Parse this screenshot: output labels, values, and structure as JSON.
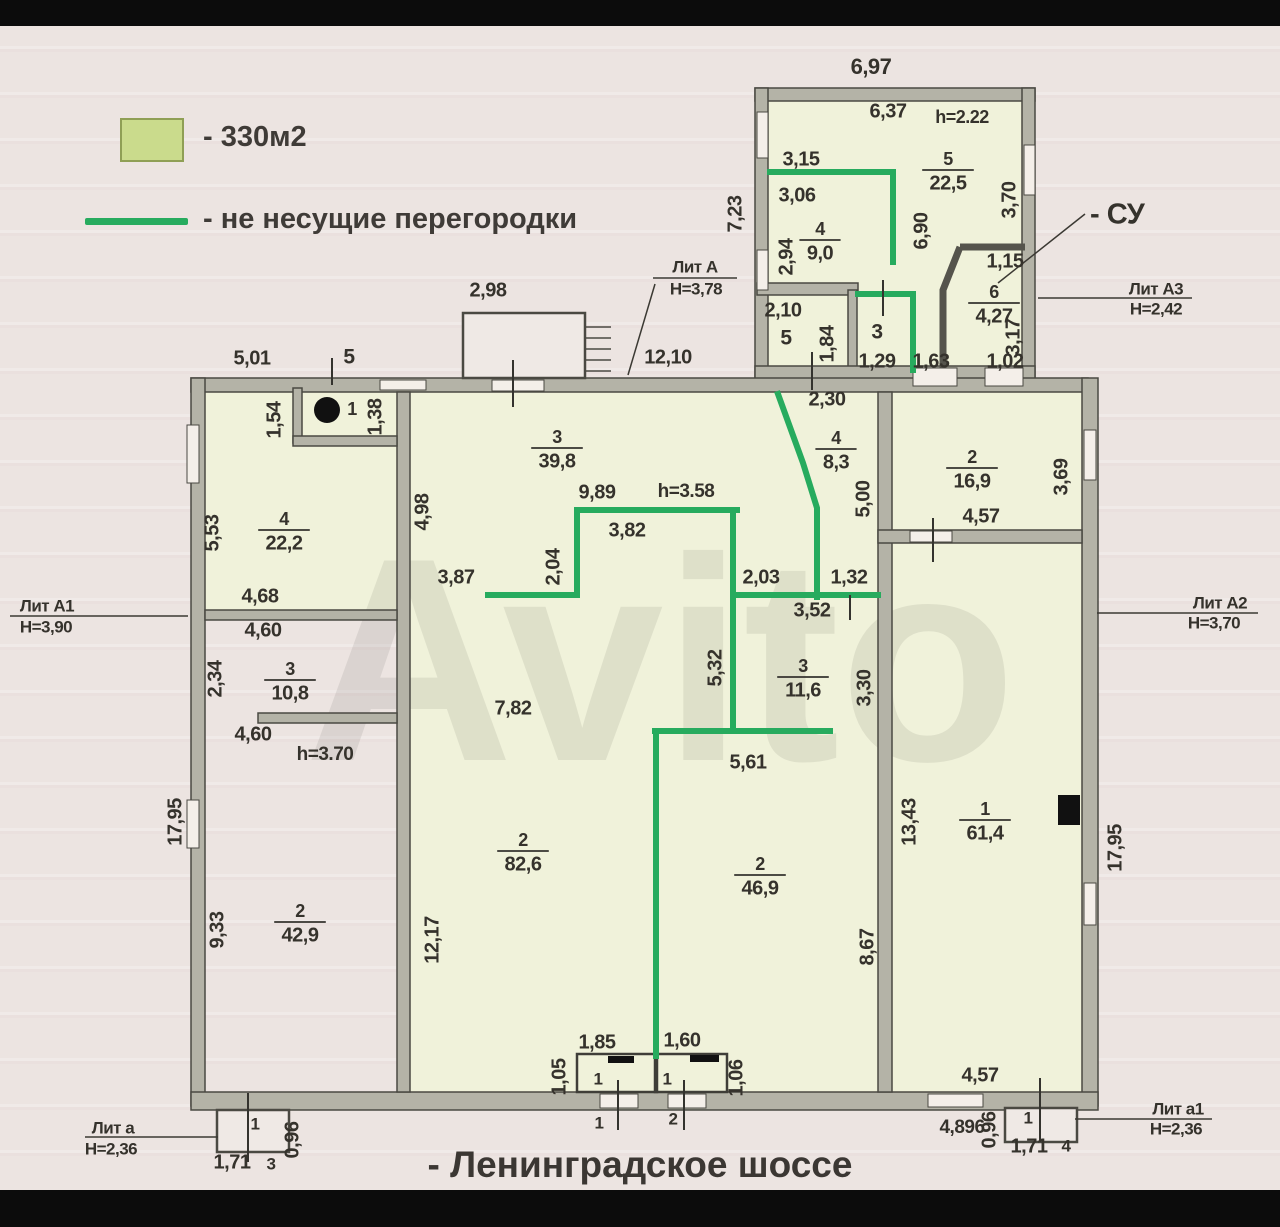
{
  "colors": {
    "paper": "#ece4e1",
    "letterbox": "#0c0c0c",
    "highlight_green_yellow": "#f0f2da",
    "partition_green": "#27ab5e",
    "legend_swatch": "#cadb8c",
    "legend_swatch_border": "#8f9f55",
    "wall_fill": "#b4b3a7",
    "wall_stroke": "#4a4942",
    "ink": "#35322c"
  },
  "legend": {
    "area_label": "- 330м2",
    "partition_label": "- не несущие перегородки"
  },
  "street_label": "- Ленинградское шоссе",
  "watermark": "Avito",
  "plan": {
    "highlights": [
      [
        762,
        98,
        262,
        270
      ],
      [
        205,
        392,
        192,
        220
      ],
      [
        410,
        392,
        468,
        700
      ],
      [
        892,
        392,
        190,
        700
      ]
    ],
    "walls": [
      [
        755,
        88,
        280,
        13
      ],
      [
        755,
        88,
        13,
        292
      ],
      [
        1022,
        88,
        13,
        292
      ],
      [
        757,
        283,
        101,
        12
      ],
      [
        848,
        290,
        9,
        80
      ],
      [
        755,
        366,
        280,
        16
      ],
      [
        191,
        378,
        897,
        14
      ],
      [
        191,
        378,
        14,
        728
      ],
      [
        1082,
        378,
        16,
        728
      ],
      [
        191,
        1092,
        907,
        18
      ],
      [
        397,
        392,
        13,
        700
      ],
      [
        878,
        392,
        14,
        700
      ],
      [
        293,
        388,
        9,
        55
      ],
      [
        293,
        436,
        104,
        10
      ],
      [
        205,
        610,
        192,
        10
      ],
      [
        258,
        713,
        139,
        10
      ],
      [
        878,
        530,
        204,
        13
      ]
    ],
    "wall_paths": [
      [
        [
          960,
          247
        ],
        [
          943,
          290
        ],
        [
          943,
          368
        ]
      ],
      [
        [
          960,
          247
        ],
        [
          1025,
          247
        ]
      ]
    ],
    "windows": [
      [
        187,
        425,
        12,
        58
      ],
      [
        187,
        800,
        12,
        48
      ],
      [
        757,
        112,
        11,
        46
      ],
      [
        757,
        250,
        11,
        40
      ],
      [
        1024,
        145,
        11,
        50
      ],
      [
        1084,
        430,
        12,
        50
      ],
      [
        1084,
        883,
        12,
        42
      ],
      [
        380,
        380,
        46,
        10
      ],
      [
        492,
        380,
        52,
        11
      ],
      [
        913,
        368,
        44,
        18
      ],
      [
        985,
        368,
        38,
        18
      ],
      [
        910,
        531,
        42,
        11
      ],
      [
        600,
        1094,
        38,
        14
      ],
      [
        668,
        1094,
        38,
        14
      ],
      [
        928,
        1094,
        55,
        13
      ]
    ],
    "porches": [
      [
        463,
        313,
        122,
        65
      ],
      [
        217,
        1110,
        72,
        42
      ],
      [
        1005,
        1108,
        72,
        34
      ]
    ],
    "vestibules": [
      [
        577,
        1054,
        80,
        38
      ],
      [
        655,
        1054,
        72,
        38
      ]
    ],
    "steps": {
      "x1": 585,
      "x2": 611,
      "y": 327,
      "dy": 11,
      "n": 5
    },
    "greens": [
      [
        [
          770,
          172
        ],
        [
          893,
          172
        ],
        [
          893,
          262
        ]
      ],
      [
        [
          858,
          294
        ],
        [
          913,
          294
        ],
        [
          913,
          370
        ]
      ],
      [
        [
          778,
          394
        ],
        [
          803,
          463
        ],
        [
          817,
          508
        ],
        [
          817,
          597
        ]
      ],
      [
        [
          488,
          595
        ],
        [
          577,
          595
        ],
        [
          577,
          510
        ],
        [
          737,
          510
        ]
      ],
      [
        [
          733,
          510
        ],
        [
          733,
          731
        ]
      ],
      [
        [
          733,
          595
        ],
        [
          878,
          595
        ]
      ],
      [
        [
          655,
          731
        ],
        [
          830,
          731
        ]
      ],
      [
        [
          656,
          731
        ],
        [
          656,
          1056
        ]
      ]
    ],
    "lines": [
      [
        653,
        278,
        737,
        278
      ],
      [
        628,
        375,
        655,
        284
      ],
      [
        10,
        616,
        188,
        616
      ],
      [
        1097,
        613,
        1258,
        613
      ],
      [
        1038,
        298,
        1192,
        298
      ],
      [
        998,
        283,
        1085,
        214
      ],
      [
        85,
        1137,
        218,
        1137
      ],
      [
        1075,
        1119,
        1212,
        1119
      ]
    ],
    "ticks": [
      [
        332,
        358,
        332,
        385
      ],
      [
        513,
        360,
        513,
        407
      ],
      [
        812,
        352,
        812,
        390
      ],
      [
        883,
        280,
        883,
        316
      ],
      [
        933,
        518,
        933,
        562
      ],
      [
        850,
        595,
        850,
        620
      ],
      [
        618,
        1080,
        618,
        1130
      ],
      [
        684,
        1080,
        684,
        1130
      ],
      [
        248,
        1093,
        248,
        1162
      ],
      [
        1040,
        1078,
        1040,
        1142
      ]
    ],
    "icons": {
      "stove_circle": {
        "cx": 327,
        "cy": 410,
        "r": 13
      },
      "vent_square": [
        1058,
        795,
        22,
        30
      ],
      "black_marks": [
        [
          608,
          1056,
          26,
          7
        ],
        [
          690,
          1055,
          29,
          7
        ]
      ]
    },
    "labels": [
      {
        "t": "6,97",
        "x": 871,
        "y": 68,
        "s": 22
      },
      {
        "t": "6,37",
        "x": 888,
        "y": 112
      },
      {
        "t": "h=2.22",
        "x": 962,
        "y": 118,
        "s": 18
      },
      {
        "t": "3,15",
        "x": 801,
        "y": 160
      },
      {
        "t": "3,06",
        "x": 797,
        "y": 196
      },
      {
        "t": "7,23",
        "x": 736,
        "y": 214,
        "r": 1
      },
      {
        "t": "2,94",
        "x": 787,
        "y": 257,
        "r": 1
      },
      {
        "t": "6,90",
        "x": 922,
        "y": 231,
        "r": 1
      },
      {
        "t": "3,70",
        "x": 1010,
        "y": 200,
        "r": 1
      },
      {
        "t": "1,15",
        "x": 1005,
        "y": 262
      },
      {
        "t": "3,17",
        "x": 1014,
        "y": 337,
        "r": 1
      },
      {
        "t": "2,10",
        "x": 783,
        "y": 311
      },
      {
        "t": "5",
        "x": 786,
        "y": 339,
        "s": 21
      },
      {
        "t": "1,84",
        "x": 828,
        "y": 344,
        "r": 1
      },
      {
        "t": "3",
        "x": 877,
        "y": 333,
        "s": 21
      },
      {
        "t": "1,29",
        "x": 877,
        "y": 362
      },
      {
        "t": "1,63",
        "x": 931,
        "y": 362
      },
      {
        "t": "1,02",
        "x": 1005,
        "y": 362
      },
      {
        "t": "2,30",
        "x": 827,
        "y": 400
      },
      {
        "t": "2,98",
        "x": 488,
        "y": 291
      },
      {
        "t": "12,10",
        "x": 668,
        "y": 358
      },
      {
        "t": "5,01",
        "x": 252,
        "y": 359
      },
      {
        "t": "5",
        "x": 349,
        "y": 358,
        "s": 21
      },
      {
        "t": "1,54",
        "x": 275,
        "y": 420,
        "r": 1
      },
      {
        "t": "1",
        "x": 352,
        "y": 410,
        "s": 18
      },
      {
        "t": "1,38",
        "x": 376,
        "y": 417,
        "r": 1
      },
      {
        "t": "5,53",
        "x": 213,
        "y": 533,
        "r": 1
      },
      {
        "t": "4,98",
        "x": 423,
        "y": 512,
        "r": 1
      },
      {
        "t": "4,68",
        "x": 260,
        "y": 597
      },
      {
        "t": "4,60",
        "x": 263,
        "y": 631
      },
      {
        "t": "2,34",
        "x": 216,
        "y": 679,
        "r": 1
      },
      {
        "t": "4,60",
        "x": 253,
        "y": 735
      },
      {
        "t": "h=3.70",
        "x": 325,
        "y": 755,
        "s": 19
      },
      {
        "t": "9,89",
        "x": 597,
        "y": 493
      },
      {
        "t": "h=3.58",
        "x": 686,
        "y": 492,
        "s": 19
      },
      {
        "t": "3,82",
        "x": 627,
        "y": 531
      },
      {
        "t": "2,04",
        "x": 554,
        "y": 567,
        "r": 1
      },
      {
        "t": "3,87",
        "x": 456,
        "y": 578
      },
      {
        "t": "2,03",
        "x": 761,
        "y": 578
      },
      {
        "t": "1,32",
        "x": 849,
        "y": 578
      },
      {
        "t": "3,52",
        "x": 812,
        "y": 611
      },
      {
        "t": "5,00",
        "x": 864,
        "y": 499,
        "r": 1
      },
      {
        "t": "3,69",
        "x": 1062,
        "y": 477,
        "r": 1
      },
      {
        "t": "4,57",
        "x": 981,
        "y": 517
      },
      {
        "t": "5,32",
        "x": 716,
        "y": 668,
        "r": 1
      },
      {
        "t": "3,30",
        "x": 865,
        "y": 688,
        "r": 1
      },
      {
        "t": "5,61",
        "x": 748,
        "y": 763
      },
      {
        "t": "7,82",
        "x": 513,
        "y": 709
      },
      {
        "t": "13,43",
        "x": 910,
        "y": 822,
        "r": 1
      },
      {
        "t": "17,95",
        "x": 1116,
        "y": 848,
        "r": 1
      },
      {
        "t": "17,95",
        "x": 176,
        "y": 822,
        "r": 1
      },
      {
        "t": "9,33",
        "x": 218,
        "y": 930,
        "r": 1
      },
      {
        "t": "12,17",
        "x": 433,
        "y": 940,
        "r": 1
      },
      {
        "t": "8,67",
        "x": 868,
        "y": 947,
        "r": 1
      },
      {
        "t": "1,85",
        "x": 597,
        "y": 1043
      },
      {
        "t": "1,60",
        "x": 682,
        "y": 1041
      },
      {
        "t": "1,05",
        "x": 560,
        "y": 1077,
        "r": 1
      },
      {
        "t": "1,06",
        "x": 737,
        "y": 1078,
        "r": 1
      },
      {
        "t": "1",
        "x": 598,
        "y": 1080,
        "s": 17
      },
      {
        "t": "1",
        "x": 667,
        "y": 1080,
        "s": 17
      },
      {
        "t": "1",
        "x": 599,
        "y": 1124,
        "s": 17
      },
      {
        "t": "2",
        "x": 673,
        "y": 1120,
        "s": 17
      },
      {
        "t": "4,57",
        "x": 980,
        "y": 1076
      },
      {
        "t": "4,896",
        "x": 962,
        "y": 1128,
        "s": 19
      },
      {
        "t": "0,96",
        "x": 990,
        "y": 1130,
        "r": 1
      },
      {
        "t": "1",
        "x": 1028,
        "y": 1119,
        "s": 17
      },
      {
        "t": "1,71",
        "x": 1029,
        "y": 1147
      },
      {
        "t": "4",
        "x": 1066,
        "y": 1147,
        "s": 17
      },
      {
        "t": "1",
        "x": 255,
        "y": 1125,
        "s": 17
      },
      {
        "t": "1,71",
        "x": 232,
        "y": 1163
      },
      {
        "t": "3",
        "x": 271,
        "y": 1165,
        "s": 17
      },
      {
        "t": "0,96",
        "x": 293,
        "y": 1140,
        "r": 1
      },
      {
        "t": "- СУ",
        "x": 1090,
        "y": 216,
        "s": 29,
        "a": "s"
      }
    ],
    "fractions": [
      {
        "n": "5",
        "d": "22,5",
        "x": 948,
        "y": 170
      },
      {
        "n": "4",
        "d": "9,0",
        "x": 820,
        "y": 240
      },
      {
        "n": "6",
        "d": "4,27",
        "x": 994,
        "y": 303
      },
      {
        "n": "3",
        "d": "39,8",
        "x": 557,
        "y": 448
      },
      {
        "n": "4",
        "d": "8,3",
        "x": 836,
        "y": 449
      },
      {
        "n": "2",
        "d": "16,9",
        "x": 972,
        "y": 468
      },
      {
        "n": "4",
        "d": "22,2",
        "x": 284,
        "y": 530
      },
      {
        "n": "3",
        "d": "10,8",
        "x": 290,
        "y": 680
      },
      {
        "n": "3",
        "d": "11,6",
        "x": 803,
        "y": 677
      },
      {
        "n": "2",
        "d": "82,6",
        "x": 523,
        "y": 851
      },
      {
        "n": "2",
        "d": "46,9",
        "x": 760,
        "y": 875
      },
      {
        "n": "1",
        "d": "61,4",
        "x": 985,
        "y": 820
      },
      {
        "n": "2",
        "d": "42,9",
        "x": 300,
        "y": 922
      }
    ],
    "annotations": [
      {
        "t": "Лит А",
        "x": 695,
        "y": 268
      },
      {
        "t": "Н=3,78",
        "x": 696,
        "y": 290
      },
      {
        "t": "Лит А1",
        "x": 47,
        "y": 607
      },
      {
        "t": "Н=3,90",
        "x": 46,
        "y": 628
      },
      {
        "t": "Лит А2",
        "x": 1220,
        "y": 604
      },
      {
        "t": "Н=3,70",
        "x": 1214,
        "y": 624
      },
      {
        "t": "Лит А3",
        "x": 1156,
        "y": 290
      },
      {
        "t": "Н=2,42",
        "x": 1156,
        "y": 310
      },
      {
        "t": "Лит а",
        "x": 113,
        "y": 1129
      },
      {
        "t": "Н=2,36",
        "x": 111,
        "y": 1150
      },
      {
        "t": "Лит а1",
        "x": 1178,
        "y": 1110
      },
      {
        "t": "Н=2,36",
        "x": 1176,
        "y": 1130
      }
    ]
  }
}
